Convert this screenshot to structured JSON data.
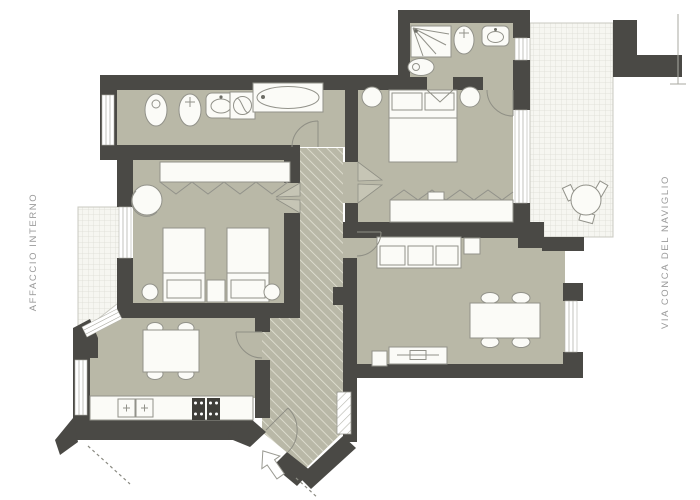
{
  "type": "architectural-floor-plan",
  "labels": {
    "left_street": "AFFACCIO INTERNO",
    "right_street": "VIA CONCA DEL NAVIGLIO"
  },
  "palette": {
    "background": "#ffffff",
    "wall": "#4a4945",
    "floor": "#b9b8a7",
    "hatch_line": "#e3e2d5",
    "balcony_fill": "#f6f6f1",
    "balcony_grid": "#dcdcd3",
    "furniture_fill": "#fbfbf7",
    "furniture_outline": "#92928a",
    "appliance_dark": "#3f3e39",
    "label_text": "#9a9a9a"
  },
  "rooms": [
    {
      "id": "bathroom-main",
      "fixtures": [
        "window",
        "bidet",
        "toilet",
        "washbasin",
        "washing-machine",
        "bathtub"
      ]
    },
    {
      "id": "bedroom-twin",
      "fixtures": [
        "wardrobe",
        "armchair",
        "single-bed",
        "single-bed",
        "nightstand",
        "stool",
        "stool",
        "window"
      ]
    },
    {
      "id": "kitchen",
      "fixtures": [
        "dining-table",
        "chairs",
        "counter",
        "double-sink",
        "stove",
        "window"
      ]
    },
    {
      "id": "hallway",
      "fixtures": [
        "entrance-door",
        "entrance-arrow",
        "niche"
      ]
    },
    {
      "id": "master-bedroom",
      "fixtures": [
        "double-bed",
        "side-table",
        "side-table",
        "wardrobe",
        "window"
      ]
    },
    {
      "id": "bathroom-second",
      "fixtures": [
        "shower",
        "bidet",
        "toilet",
        "washbasin",
        "window"
      ]
    },
    {
      "id": "living-room",
      "fixtures": [
        "sofa",
        "side-table",
        "dining-table",
        "chairs",
        "tv-sideboard",
        "window"
      ]
    },
    {
      "id": "balcony-left",
      "fixtures": []
    },
    {
      "id": "balcony-right",
      "fixtures": [
        "round-table",
        "chairs"
      ]
    }
  ]
}
